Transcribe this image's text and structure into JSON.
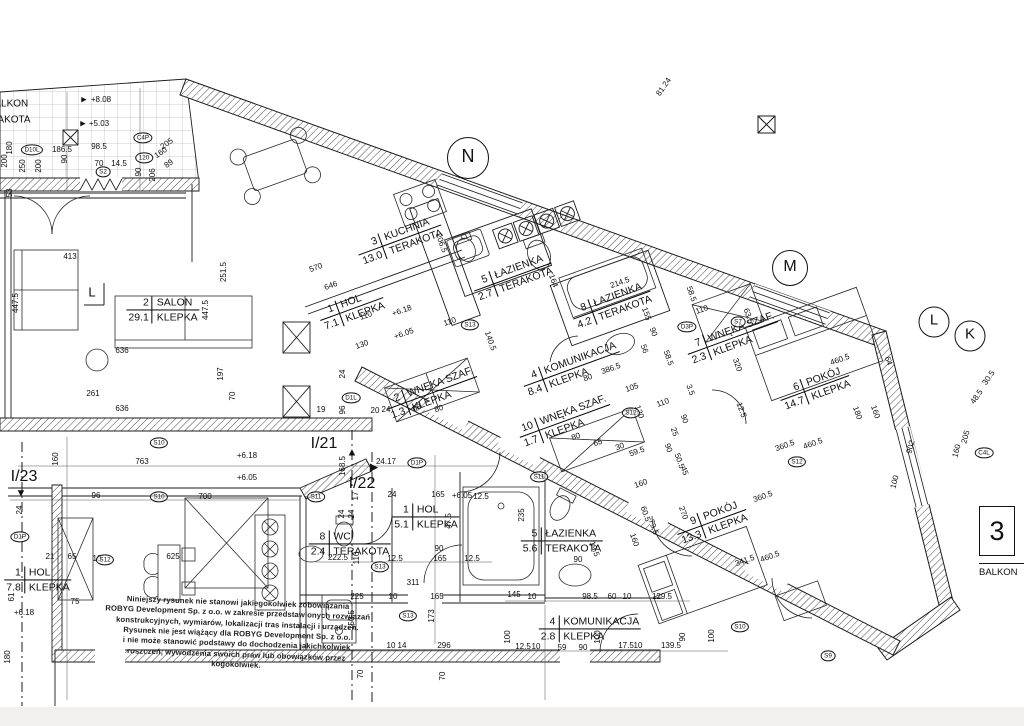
{
  "sheet": {
    "edge_number": "3",
    "edge_label": "BALKON"
  },
  "balcony": {
    "line1": "BALKON",
    "line2": "TERAKOTA"
  },
  "rooms": [
    {
      "num": "3",
      "name": "KUCHNIA",
      "area": "13.0",
      "finish": "TERAKOTA",
      "x": 400,
      "y": 240,
      "rot": -20
    },
    {
      "num": "5",
      "name": "ŁAZIENKA",
      "area": "2.7",
      "finish": "TERAKOTA",
      "x": 513,
      "y": 277,
      "rot": -20
    },
    {
      "num": "8",
      "name": "ŁAZIENKA",
      "area": "4.2",
      "finish": "TERAKOTA",
      "x": 612,
      "y": 305,
      "rot": -20
    },
    {
      "num": "1",
      "name": "HOL",
      "area": "7.1",
      "finish": "KLEPKA",
      "x": 352,
      "y": 309,
      "rot": -20
    },
    {
      "num": "2",
      "name": "SALON",
      "area": "29.1",
      "finish": "KLEPKA",
      "x": 163,
      "y": 310,
      "rot": 0
    },
    {
      "num": "4",
      "name": "KOMUNIKACJA",
      "area": "8.4",
      "finish": "KLEPKA",
      "x": 572,
      "y": 369,
      "rot": -20
    },
    {
      "num": "7",
      "name": "WNĘKA SZAF.",
      "area": "2.3",
      "finish": "KLEPKA",
      "x": 733,
      "y": 338,
      "rot": -20
    },
    {
      "num": "6",
      "name": "POKÓJ",
      "area": "14.7",
      "finish": "KLEPKA",
      "x": 815,
      "y": 388,
      "rot": -20
    },
    {
      "num": "2",
      "name": "WNĘKA SZAF.",
      "area": "1.3",
      "finish": "KLEPKA",
      "x": 432,
      "y": 393,
      "rot": -20
    },
    {
      "num": "10",
      "name": "WNĘKA SZAF.",
      "area": "1.7",
      "finish": "KLEPKA",
      "x": 565,
      "y": 421,
      "rot": -20
    },
    {
      "num": "9",
      "name": "POKÓJ",
      "area": "13.3",
      "finish": "KLEPKA",
      "x": 712,
      "y": 522,
      "rot": -20
    },
    {
      "num": "5",
      "name": "ŁAZIENKA",
      "area": "5.6",
      "finish": "TERAKOTA",
      "x": 562,
      "y": 541,
      "rot": 0
    },
    {
      "num": "1",
      "name": "HOL",
      "area": "5.1",
      "finish": "KLEPKA",
      "x": 426,
      "y": 517,
      "rot": 0
    },
    {
      "num": "8",
      "name": "WC",
      "area": "2.4",
      "finish": "TERAKOTA",
      "x": 350,
      "y": 544,
      "rot": 0
    },
    {
      "num": "4",
      "name": "KOMUNIKACJA",
      "area": "2.8",
      "finish": "KLEPKA",
      "x": 590,
      "y": 629,
      "rot": 0
    },
    {
      "num": "1",
      "name": "HOL",
      "area": "7.8",
      "finish": "KLEPKA",
      "x": 38,
      "y": 580,
      "rot": 0
    }
  ],
  "grid_marks": [
    {
      "t": "N",
      "x": 468,
      "y": 158,
      "d": 40,
      "fs": 18
    },
    {
      "t": "M",
      "x": 790,
      "y": 268,
      "d": 34,
      "fs": 16
    },
    {
      "t": "L",
      "x": 934,
      "y": 322,
      "d": 29,
      "fs": 15
    },
    {
      "t": "K",
      "x": 970,
      "y": 336,
      "d": 29,
      "fs": 15
    }
  ],
  "big_labels": [
    {
      "t": "BALKON",
      "x": 8,
      "y": 104,
      "fs": 10
    },
    {
      "t": "TERAKOTA",
      "x": 4,
      "y": 120,
      "fs": 10
    },
    {
      "t": "I/21",
      "x": 324,
      "y": 444,
      "fs": 16
    },
    {
      "t": "I/22",
      "x": 362,
      "y": 484,
      "fs": 16
    },
    {
      "t": "I/23",
      "x": 24,
      "y": 477,
      "fs": 16
    },
    {
      "t": "L",
      "x": 92,
      "y": 292,
      "fs": 13
    }
  ],
  "glyphs": [
    {
      "t": "▲",
      "x": 352,
      "y": 453,
      "fs": 11
    },
    {
      "t": "▶",
      "x": 374,
      "y": 468,
      "fs": 11
    },
    {
      "t": "▼",
      "x": 21,
      "y": 494,
      "fs": 11
    },
    {
      "t": "▶",
      "x": 84,
      "y": 100,
      "fs": 7
    },
    {
      "t": "▶",
      "x": 83,
      "y": 124,
      "fs": 7
    }
  ],
  "markers": [
    {
      "t": "S2",
      "x": 103,
      "y": 172
    },
    {
      "t": "S7",
      "x": 738,
      "y": 322
    },
    {
      "t": "S10",
      "x": 159,
      "y": 443
    },
    {
      "t": "S10",
      "x": 159,
      "y": 497
    },
    {
      "t": "S10",
      "x": 740,
      "y": 627
    },
    {
      "t": "S11",
      "x": 316,
      "y": 497
    },
    {
      "t": "S11",
      "x": 539,
      "y": 477
    },
    {
      "t": "S12",
      "x": 105,
      "y": 560
    },
    {
      "t": "S12",
      "x": 631,
      "y": 413
    },
    {
      "t": "S12",
      "x": 797,
      "y": 462
    },
    {
      "t": "S13",
      "x": 380,
      "y": 567
    },
    {
      "t": "S13",
      "x": 470,
      "y": 325
    },
    {
      "t": "S13",
      "x": 408,
      "y": 616
    },
    {
      "t": "S9",
      "x": 828,
      "y": 656
    },
    {
      "t": "D10L",
      "x": 32,
      "y": 150
    },
    {
      "t": "C4P",
      "x": 143,
      "y": 138
    },
    {
      "t": "120",
      "x": 144,
      "y": 158
    },
    {
      "t": "D1P",
      "x": 20,
      "y": 537
    },
    {
      "t": "D1L",
      "x": 351,
      "y": 398
    },
    {
      "t": "D1P",
      "x": 417,
      "y": 463
    },
    {
      "t": "D3P",
      "x": 687,
      "y": 327
    },
    {
      "t": "C4L",
      "x": 984,
      "y": 453
    }
  ],
  "dims": [
    {
      "t": "+8.08",
      "x": 101,
      "y": 100
    },
    {
      "t": "+5.03",
      "x": 99,
      "y": 124
    },
    {
      "t": "180",
      "x": 10,
      "y": 148,
      "rot": -90
    },
    {
      "t": "200",
      "x": 5,
      "y": 161,
      "rot": -90
    },
    {
      "t": "250",
      "x": 23,
      "y": 166,
      "rot": -90
    },
    {
      "t": "200",
      "x": 39,
      "y": 166,
      "rot": -90
    },
    {
      "t": "186.5",
      "x": 62,
      "y": 150
    },
    {
      "t": "98.5",
      "x": 99,
      "y": 147
    },
    {
      "t": "90",
      "x": 65,
      "y": 159,
      "rot": -90
    },
    {
      "t": "70",
      "x": 99,
      "y": 164
    },
    {
      "t": "14.5",
      "x": 119,
      "y": 164
    },
    {
      "t": "205",
      "x": 167,
      "y": 144,
      "rot": -35
    },
    {
      "t": "160",
      "x": 161,
      "y": 153,
      "rot": -35
    },
    {
      "t": "89",
      "x": 169,
      "y": 164,
      "rot": -35
    },
    {
      "t": "90",
      "x": 139,
      "y": 172,
      "rot": -90
    },
    {
      "t": "206",
      "x": 153,
      "y": 175,
      "rot": -90
    },
    {
      "t": "53",
      "x": 10,
      "y": 193,
      "rot": -90
    },
    {
      "t": "81.24",
      "x": 664,
      "y": 87,
      "rot": -55
    },
    {
      "t": "413",
      "x": 70,
      "y": 257
    },
    {
      "t": "447.5",
      "x": 16,
      "y": 303,
      "rot": -90
    },
    {
      "t": "447.5",
      "x": 206,
      "y": 310,
      "rot": -90
    },
    {
      "t": "251.5",
      "x": 224,
      "y": 272,
      "rot": -90
    },
    {
      "t": "636",
      "x": 122,
      "y": 351
    },
    {
      "t": "636",
      "x": 122,
      "y": 409
    },
    {
      "t": "261",
      "x": 93,
      "y": 394
    },
    {
      "t": "197",
      "x": 221,
      "y": 374,
      "rot": -90
    },
    {
      "t": "70",
      "x": 233,
      "y": 396,
      "rot": -90
    },
    {
      "t": "570",
      "x": 316,
      "y": 268,
      "rot": -20
    },
    {
      "t": "646",
      "x": 331,
      "y": 286,
      "rot": -20
    },
    {
      "t": "206.5",
      "x": 441,
      "y": 243,
      "rot": 70
    },
    {
      "t": "110",
      "x": 366,
      "y": 316,
      "rot": -20
    },
    {
      "t": "130",
      "x": 362,
      "y": 345,
      "rot": -20
    },
    {
      "t": "140.5",
      "x": 490,
      "y": 341,
      "rot": 70
    },
    {
      "t": "164",
      "x": 553,
      "y": 281,
      "rot": 70
    },
    {
      "t": "110",
      "x": 450,
      "y": 322,
      "rot": -20
    },
    {
      "t": "+6.18",
      "x": 402,
      "y": 311,
      "rot": -20
    },
    {
      "t": "+6.05",
      "x": 404,
      "y": 334,
      "rot": -20
    },
    {
      "t": "+6.18",
      "x": 247,
      "y": 456
    },
    {
      "t": "+6.05",
      "x": 247,
      "y": 478
    },
    {
      "t": "214.5",
      "x": 620,
      "y": 283,
      "rot": -20
    },
    {
      "t": "58.5",
      "x": 691,
      "y": 294,
      "rot": 70
    },
    {
      "t": "63.5",
      "x": 748,
      "y": 316,
      "rot": 70
    },
    {
      "t": "155",
      "x": 646,
      "y": 314,
      "rot": 70
    },
    {
      "t": "56",
      "x": 644,
      "y": 349,
      "rot": 70
    },
    {
      "t": "58.5",
      "x": 668,
      "y": 358,
      "rot": 70
    },
    {
      "t": "386.5",
      "x": 611,
      "y": 369,
      "rot": -20
    },
    {
      "t": "80",
      "x": 588,
      "y": 378,
      "rot": -20
    },
    {
      "t": "105",
      "x": 632,
      "y": 388,
      "rot": -20
    },
    {
      "t": "320",
      "x": 737,
      "y": 365,
      "rot": 70
    },
    {
      "t": "12.5",
      "x": 741,
      "y": 410,
      "rot": 70
    },
    {
      "t": "3.5",
      "x": 690,
      "y": 390,
      "rot": 70
    },
    {
      "t": "90",
      "x": 653,
      "y": 332,
      "rot": 70
    },
    {
      "t": "110",
      "x": 702,
      "y": 310,
      "rot": -20
    },
    {
      "t": "460.5",
      "x": 840,
      "y": 360,
      "rot": -20
    },
    {
      "t": "64",
      "x": 888,
      "y": 361,
      "rot": 70
    },
    {
      "t": "160",
      "x": 875,
      "y": 412,
      "rot": 70
    },
    {
      "t": "180",
      "x": 857,
      "y": 413,
      "rot": 70
    },
    {
      "t": "360.5",
      "x": 785,
      "y": 446,
      "rot": -20
    },
    {
      "t": "460.5",
      "x": 813,
      "y": 444,
      "rot": -20
    },
    {
      "t": "205",
      "x": 966,
      "y": 437,
      "rot": -75
    },
    {
      "t": "160",
      "x": 957,
      "y": 451,
      "rot": -75
    },
    {
      "t": "48.5",
      "x": 977,
      "y": 397,
      "rot": -55
    },
    {
      "t": "30.5",
      "x": 989,
      "y": 378,
      "rot": -55
    },
    {
      "t": "902",
      "x": 911,
      "y": 447,
      "rot": -75
    },
    {
      "t": "100",
      "x": 895,
      "y": 482,
      "rot": -75
    },
    {
      "t": "360.5",
      "x": 763,
      "y": 497,
      "rot": -20
    },
    {
      "t": "460.5",
      "x": 770,
      "y": 557,
      "rot": -20
    },
    {
      "t": "341.5",
      "x": 745,
      "y": 561,
      "rot": -20
    },
    {
      "t": "270",
      "x": 683,
      "y": 513,
      "rot": 70
    },
    {
      "t": "79.5",
      "x": 653,
      "y": 527,
      "rot": 70
    },
    {
      "t": "60.5",
      "x": 645,
      "y": 514,
      "rot": 70
    },
    {
      "t": "160",
      "x": 634,
      "y": 540,
      "rot": 70
    },
    {
      "t": "19.5",
      "x": 594,
      "y": 549,
      "rot": 70
    },
    {
      "t": "235",
      "x": 522,
      "y": 515,
      "rot": -90
    },
    {
      "t": "90",
      "x": 578,
      "y": 560
    },
    {
      "t": "98.5",
      "x": 590,
      "y": 597
    },
    {
      "t": "60",
      "x": 612,
      "y": 597
    },
    {
      "t": "10",
      "x": 627,
      "y": 597
    },
    {
      "t": "129.5",
      "x": 662,
      "y": 597
    },
    {
      "t": "145",
      "x": 514,
      "y": 595
    },
    {
      "t": "10",
      "x": 532,
      "y": 597
    },
    {
      "t": "150.5",
      "x": 352,
      "y": 620,
      "rot": -90
    },
    {
      "t": "10",
      "x": 391,
      "y": 646
    },
    {
      "t": "14",
      "x": 402,
      "y": 646
    },
    {
      "t": "296",
      "x": 444,
      "y": 646
    },
    {
      "t": "100",
      "x": 508,
      "y": 637,
      "rot": -90
    },
    {
      "t": "173",
      "x": 432,
      "y": 616,
      "rot": -90
    },
    {
      "t": "70",
      "x": 361,
      "y": 674,
      "rot": -90
    },
    {
      "t": "70",
      "x": 443,
      "y": 676,
      "rot": -90
    },
    {
      "t": "59",
      "x": 562,
      "y": 648
    },
    {
      "t": "90",
      "x": 583,
      "y": 648
    },
    {
      "t": "100",
      "x": 598,
      "y": 637,
      "rot": -90
    },
    {
      "t": "17.5",
      "x": 626,
      "y": 646
    },
    {
      "t": "10",
      "x": 638,
      "y": 646
    },
    {
      "t": "139.5",
      "x": 671,
      "y": 646
    },
    {
      "t": "90",
      "x": 683,
      "y": 637,
      "rot": -90
    },
    {
      "t": "100",
      "x": 712,
      "y": 636,
      "rot": -90
    },
    {
      "t": "763",
      "x": 142,
      "y": 462
    },
    {
      "t": "160",
      "x": 56,
      "y": 459,
      "rot": -90
    },
    {
      "t": "96",
      "x": 96,
      "y": 496
    },
    {
      "t": "700",
      "x": 205,
      "y": 497
    },
    {
      "t": "24",
      "x": 20,
      "y": 510,
      "rot": -90
    },
    {
      "t": "21",
      "x": 50,
      "y": 557
    },
    {
      "t": "65",
      "x": 72,
      "y": 557
    },
    {
      "t": "10",
      "x": 97,
      "y": 559
    },
    {
      "t": "625",
      "x": 173,
      "y": 557
    },
    {
      "t": "75",
      "x": 75,
      "y": 602
    },
    {
      "t": "61",
      "x": 12,
      "y": 597,
      "rot": -90
    },
    {
      "t": "+6.18",
      "x": 24,
      "y": 613
    },
    {
      "t": "180",
      "x": 8,
      "y": 657,
      "rot": -90
    },
    {
      "t": "311",
      "x": 413,
      "y": 583
    },
    {
      "t": "225",
      "x": 357,
      "y": 597
    },
    {
      "t": "10",
      "x": 393,
      "y": 597
    },
    {
      "t": "165",
      "x": 437,
      "y": 597
    },
    {
      "t": "222.5",
      "x": 338,
      "y": 558
    },
    {
      "t": "110",
      "x": 357,
      "y": 558,
      "rot": -90
    },
    {
      "t": "12.5",
      "x": 395,
      "y": 559
    },
    {
      "t": "165",
      "x": 440,
      "y": 559
    },
    {
      "t": "12.5",
      "x": 472,
      "y": 559
    },
    {
      "t": "24",
      "x": 342,
      "y": 514,
      "rot": -90
    },
    {
      "t": "24",
      "x": 352,
      "y": 514,
      "rot": -90
    },
    {
      "t": "17",
      "x": 356,
      "y": 496,
      "rot": -90
    },
    {
      "t": "24",
      "x": 392,
      "y": 495
    },
    {
      "t": "165",
      "x": 438,
      "y": 495
    },
    {
      "t": "+6.05",
      "x": 462,
      "y": 496
    },
    {
      "t": "12.5",
      "x": 481,
      "y": 497
    },
    {
      "t": "47.5",
      "x": 449,
      "y": 521,
      "rot": -90
    },
    {
      "t": "90",
      "x": 439,
      "y": 549
    },
    {
      "t": "24.17",
      "x": 386,
      "y": 462
    },
    {
      "t": "96",
      "x": 343,
      "y": 410,
      "rot": -90
    },
    {
      "t": "19",
      "x": 321,
      "y": 410
    },
    {
      "t": "20",
      "x": 375,
      "y": 411
    },
    {
      "t": "24",
      "x": 386,
      "y": 410
    },
    {
      "t": "24",
      "x": 343,
      "y": 374,
      "rot": -90
    },
    {
      "t": "68",
      "x": 417,
      "y": 408,
      "rot": -20
    },
    {
      "t": "80",
      "x": 439,
      "y": 409,
      "rot": -20
    },
    {
      "t": "168.5",
      "x": 343,
      "y": 466,
      "rot": -90
    },
    {
      "t": "80",
      "x": 576,
      "y": 437,
      "rot": -20
    },
    {
      "t": "65",
      "x": 598,
      "y": 443,
      "rot": -20
    },
    {
      "t": "30",
      "x": 620,
      "y": 447,
      "rot": -20
    },
    {
      "t": "59.5",
      "x": 637,
      "y": 452,
      "rot": -20
    },
    {
      "t": "110",
      "x": 663,
      "y": 403,
      "rot": -20
    },
    {
      "t": "120",
      "x": 639,
      "y": 412,
      "rot": 70
    },
    {
      "t": "90",
      "x": 684,
      "y": 419,
      "rot": 70
    },
    {
      "t": "25",
      "x": 674,
      "y": 432,
      "rot": 70
    },
    {
      "t": "90",
      "x": 668,
      "y": 448,
      "rot": 70
    },
    {
      "t": "50.5",
      "x": 679,
      "y": 461,
      "rot": 70
    },
    {
      "t": "45",
      "x": 684,
      "y": 471,
      "rot": 70
    },
    {
      "t": "160",
      "x": 641,
      "y": 484,
      "rot": -20
    },
    {
      "t": "12.5",
      "x": 523,
      "y": 647
    },
    {
      "t": "10",
      "x": 536,
      "y": 647
    }
  ],
  "disclaimer": {
    "lines": [
      "Niniejszy rysunek nie stanowi jakiegokolwiek zobowiązania",
      "ROBYG Development Sp. z o.o. w zakresie przedstawionych rozwiązań",
      "konstrukcyjnych, wymiarów, lokalizacji tras instalacji i urządzeń.",
      "Rysunek nie jest wiążący dla ROBYG Development Sp. z o.o.",
      "i nie może stanowić podstawy do dochodzenia jakichkolwiek",
      "roszczeń, wywodzenia swoich praw lub obowiązków przez kogokolwiek."
    ]
  },
  "colors": {
    "line": "#1b1b1b",
    "hatch": "#4a4a4a",
    "tile_grid": "#9a9a9a"
  }
}
